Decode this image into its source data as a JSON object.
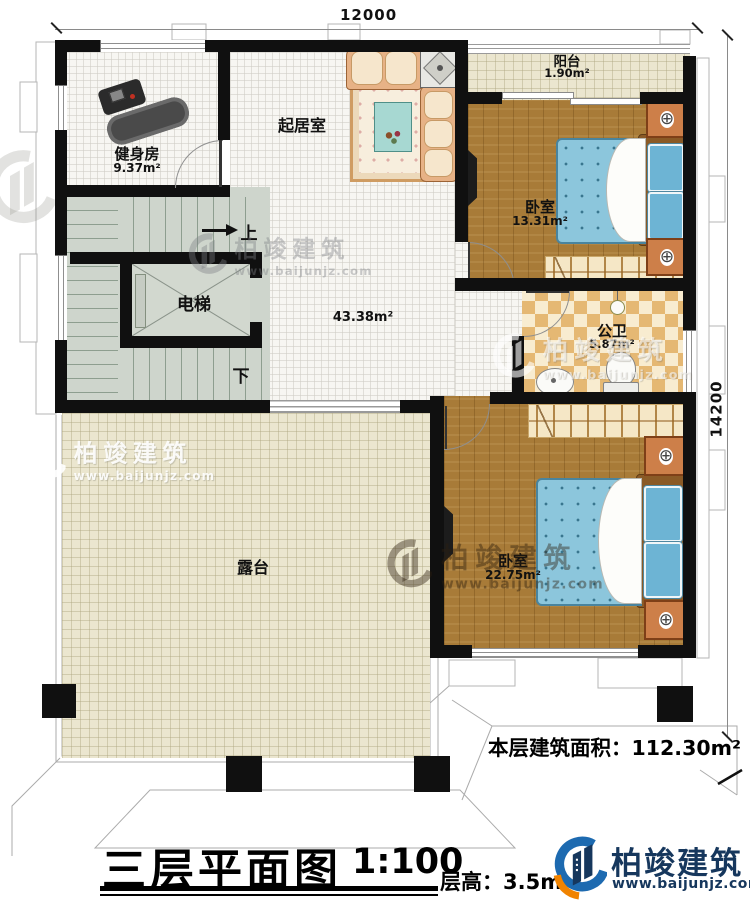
{
  "header": {
    "dim_top": "12000",
    "dim_right": "14200"
  },
  "rooms": {
    "gym": {
      "name": "健身房",
      "area": "9.37m²"
    },
    "living": {
      "name": "起居室",
      "area": "43.38m²"
    },
    "balcony": {
      "name": "阳台",
      "area": "1.90m²"
    },
    "bedroom1": {
      "name": "卧室",
      "area": "13.31m²"
    },
    "bathroom": {
      "name": "公卫",
      "area": "5.87m²"
    },
    "bedroom2": {
      "name": "卧室",
      "area": "22.75m²"
    },
    "elevator": {
      "name": "电梯"
    },
    "terrace": {
      "name": "露台"
    }
  },
  "stairs": {
    "up_label": "上",
    "down_label": "下"
  },
  "footer": {
    "floor_area_label": "本层建筑面积：",
    "floor_area_value": "112.30m²",
    "title": "三层平面图",
    "scale": "1:100",
    "floor_height": "层高：3.5m"
  },
  "branding": {
    "watermark_brand": "柏竣建筑",
    "watermark_url": "www.baijunjz.com",
    "logo_brand": "柏竣建筑",
    "logo_url": "www.baijunjz.com"
  },
  "icons": {
    "nightstand_knob": "⊕"
  },
  "colors": {
    "wall": "#101010",
    "accent_orange": "#f08300",
    "logo_navy": "#16375d",
    "logo_blue": "#1d6ab0",
    "wood": "#a87b38",
    "mattress": "#8cc6dc"
  }
}
